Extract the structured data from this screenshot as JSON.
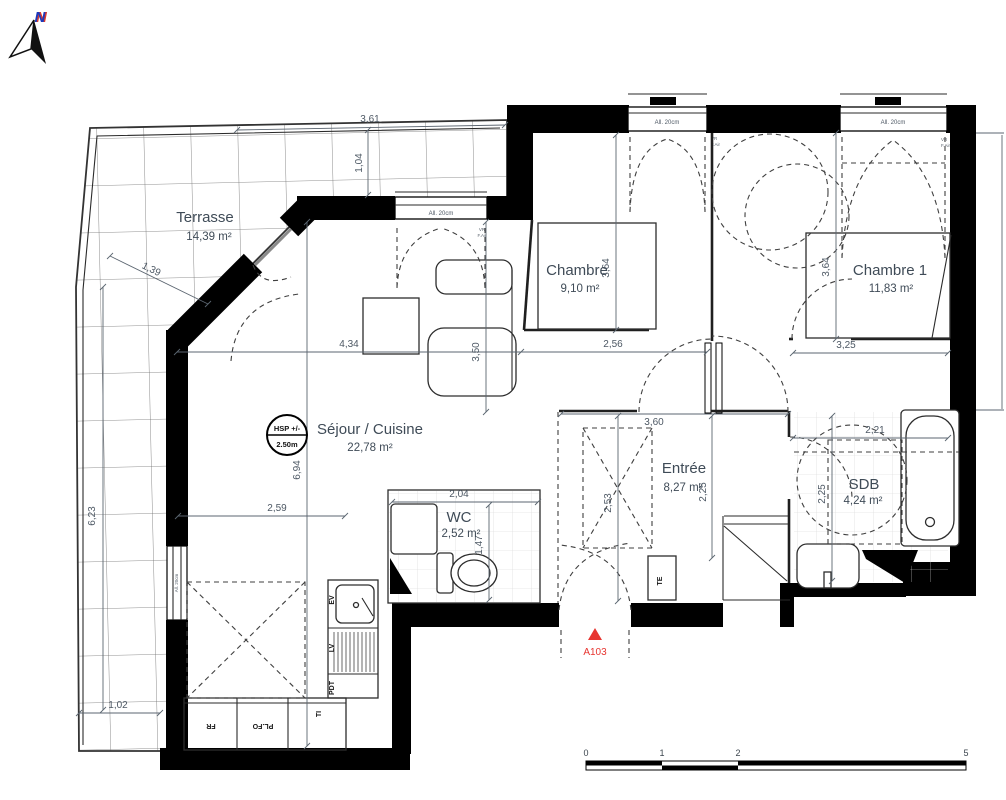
{
  "plan": {
    "north": "N",
    "marker": {
      "id": "A103"
    },
    "ceiling_badge": {
      "line1": "HSP +/-",
      "line2": "2.50m"
    },
    "window_sill": "All. 20cm",
    "vent": {
      "l1": "VR",
      "l2": "F.Air"
    },
    "rooms": {
      "terrasse": {
        "name": "Terrasse",
        "area": "14,39 m²"
      },
      "sejour": {
        "name": "Séjour / Cuisine",
        "area": "22,78 m²"
      },
      "chambre": {
        "name": "Chambre",
        "area": "9,10 m²"
      },
      "chambre1": {
        "name": "Chambre 1",
        "area": "11,83 m²"
      },
      "entree": {
        "name": "Entrée",
        "area": "8,27 m²"
      },
      "wc": {
        "name": "WC",
        "area": "2,52 m²"
      },
      "sdb": {
        "name": "SDB",
        "area": "4,24 m²"
      }
    },
    "dims": {
      "top_width": "3,61",
      "top_depth": "1,04",
      "diag": "1,39",
      "terrace_height": "6,23",
      "terrace_bottom": "1,02",
      "sejour_width": "4,34",
      "sejour_depth": "3,50",
      "sejour_height": "6,94",
      "sejour_lower": "2,59",
      "chambre_width": "2,56",
      "chambre_depth": "3,64",
      "chambre1_width": "3,25",
      "chambre1_depth": "3,64",
      "hall_width": "3,60",
      "wc_width": "2,04",
      "wc_depth": "1,47",
      "hall_depth": "2,53",
      "entree_depth": "2,25",
      "sdb_width": "2,21",
      "sdb_depth": "2,25"
    },
    "kitchen": {
      "ev": "EV",
      "lv": "LV",
      "pdt": "PDT",
      "ti": "TI",
      "fr": "FR",
      "plfo": "PL.FO"
    },
    "electrical": "TE",
    "scale_bar": {
      "t0": "0",
      "t1": "1",
      "t2": "2",
      "t5": "5"
    },
    "colors": {
      "marker": "#e73530",
      "ink": "#3f4b57",
      "wall": "#000000",
      "north_blue": "#1c39bb"
    }
  }
}
